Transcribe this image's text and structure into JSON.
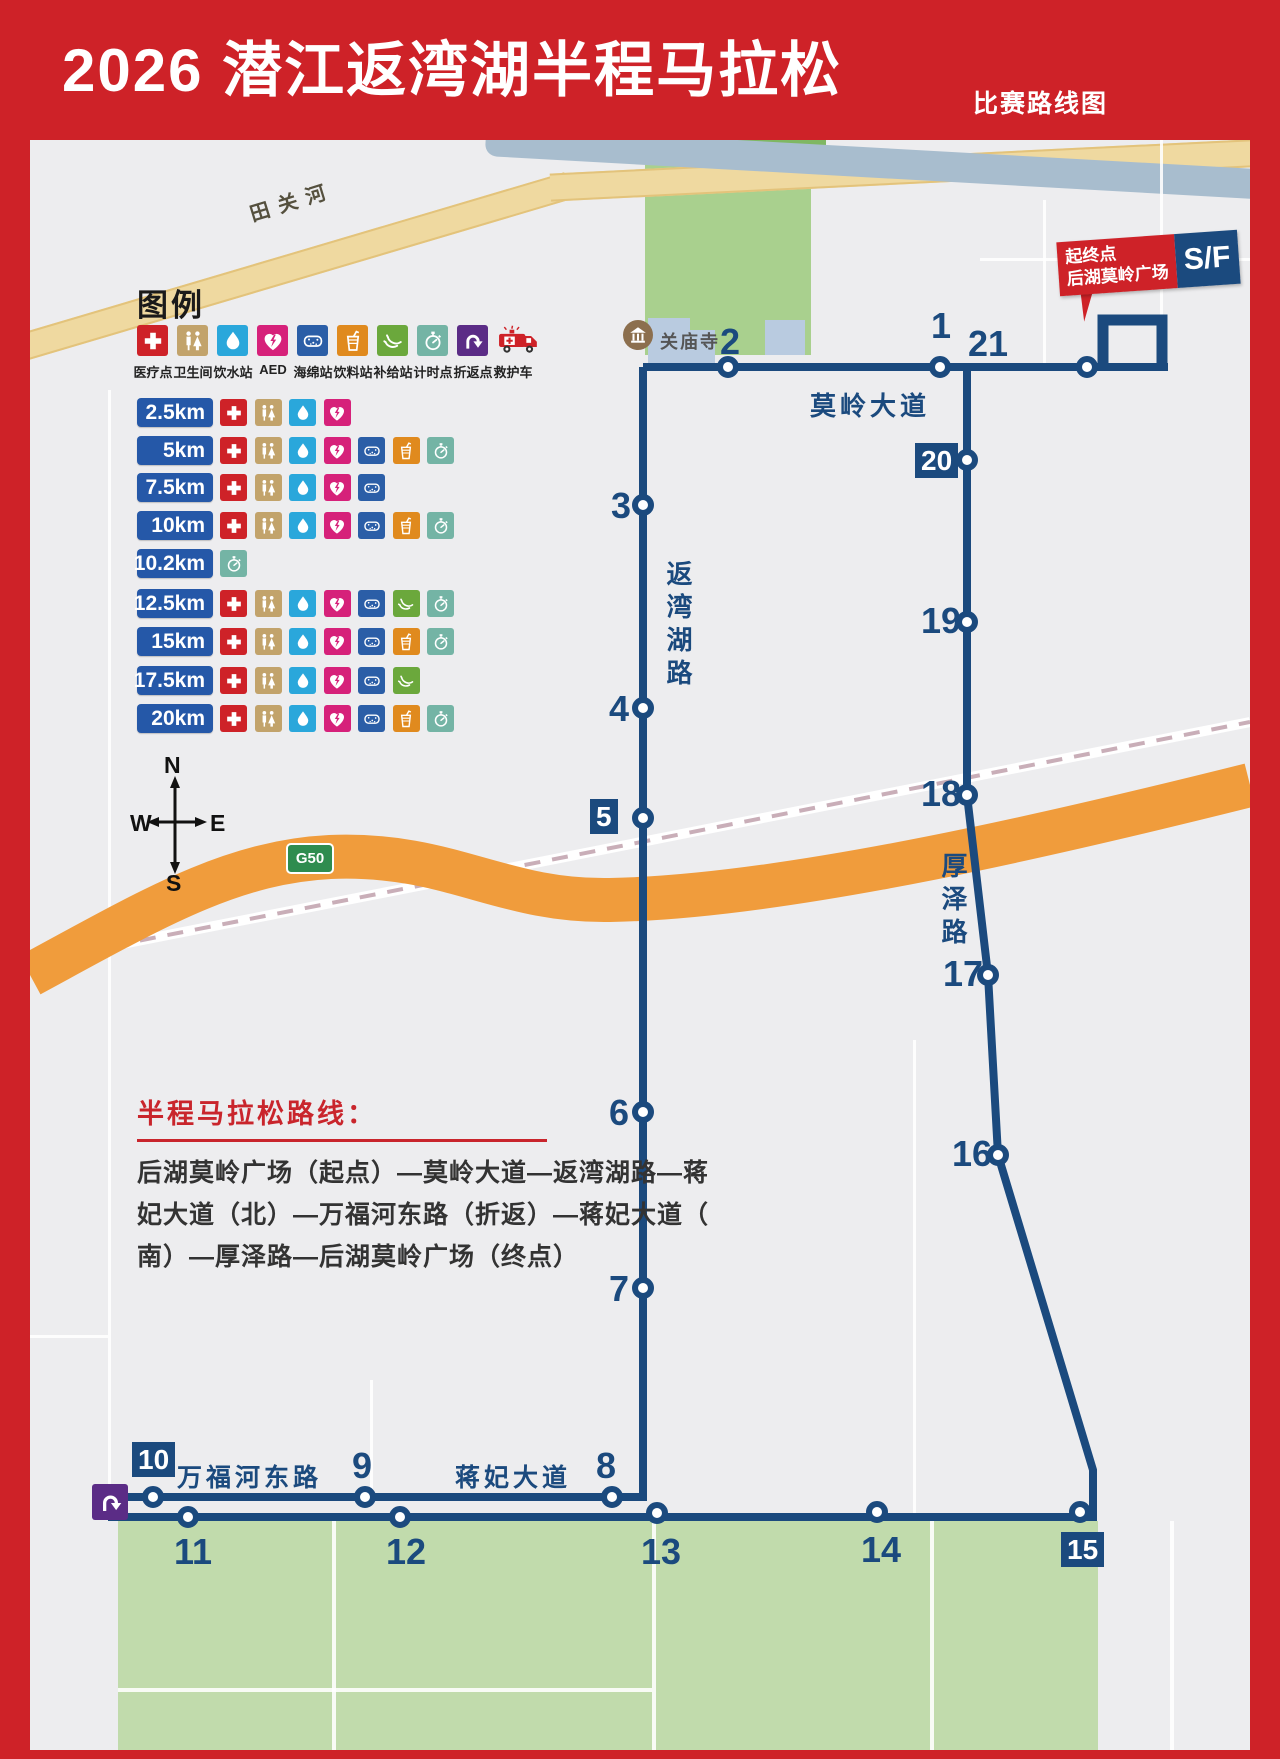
{
  "header": {
    "title": "2026 潜江返湾湖半程马拉松",
    "subtitle": "比赛路线图"
  },
  "legend": {
    "title": "图例",
    "items": [
      {
        "icon": "medical",
        "label": "医疗点"
      },
      {
        "icon": "toilet",
        "label": "卫生间"
      },
      {
        "icon": "water",
        "label": "饮水站"
      },
      {
        "icon": "aed",
        "label": "AED"
      },
      {
        "icon": "sponge",
        "label": "海绵站"
      },
      {
        "icon": "drink",
        "label": "饮料站"
      },
      {
        "icon": "banana",
        "label": "补给站"
      },
      {
        "icon": "timer",
        "label": "计时点"
      },
      {
        "icon": "uturn",
        "label": "折返点"
      },
      {
        "icon": "ambulance",
        "label": "救护车"
      }
    ],
    "rows": [
      {
        "km": "2.5km",
        "icons": [
          "medical",
          "toilet",
          "water",
          "aed"
        ]
      },
      {
        "km": "5km",
        "icons": [
          "medical",
          "toilet",
          "water",
          "aed",
          "sponge",
          "drink",
          "timer"
        ]
      },
      {
        "km": "7.5km",
        "icons": [
          "medical",
          "toilet",
          "water",
          "aed",
          "sponge"
        ]
      },
      {
        "km": "10km",
        "icons": [
          "medical",
          "toilet",
          "water",
          "aed",
          "sponge",
          "drink",
          "timer"
        ]
      },
      {
        "km": "10.2km",
        "icons": [
          "timer"
        ]
      },
      {
        "km": "12.5km",
        "icons": [
          "medical",
          "toilet",
          "water",
          "aed",
          "sponge",
          "banana",
          "timer"
        ]
      },
      {
        "km": "15km",
        "icons": [
          "medical",
          "toilet",
          "water",
          "aed",
          "sponge",
          "drink",
          "timer"
        ]
      },
      {
        "km": "17.5km",
        "icons": [
          "medical",
          "toilet",
          "water",
          "aed",
          "sponge",
          "banana"
        ]
      },
      {
        "km": "20km",
        "icons": [
          "medical",
          "toilet",
          "water",
          "aed",
          "sponge",
          "drink",
          "timer"
        ]
      }
    ]
  },
  "compass": {
    "n": "N",
    "s": "S",
    "w": "W",
    "e": "E"
  },
  "map": {
    "river_label": "田关河",
    "temple_label": "关庙寺",
    "g50": "G50",
    "sf": {
      "line1": "起终点",
      "line2": "后湖莫岭广场",
      "badge": "S/F"
    },
    "roads": {
      "moling": "莫岭大道",
      "fanwanhu": "返湾湖路",
      "houze": "厚泽路",
      "wanfuhe": "万福河东路",
      "jiangfei": "蒋妃大道"
    },
    "markers": [
      {
        "n": "1",
        "cx": 910,
        "cy": 227,
        "lx": 901,
        "ly": 168,
        "badge": false
      },
      {
        "n": "2",
        "cx": 698,
        "cy": 227,
        "lx": 690,
        "ly": 184,
        "badge": false
      },
      {
        "n": "3",
        "cx": 613,
        "cy": 365,
        "lx": 581,
        "ly": 348,
        "badge": false
      },
      {
        "n": "4",
        "cx": 613,
        "cy": 568,
        "lx": 579,
        "ly": 551,
        "badge": false
      },
      {
        "n": "5",
        "cx": 613,
        "cy": 678,
        "lx": 560,
        "ly": 659,
        "badge": true
      },
      {
        "n": "6",
        "cx": 613,
        "cy": 972,
        "lx": 579,
        "ly": 955,
        "badge": false
      },
      {
        "n": "7",
        "cx": 613,
        "cy": 1148,
        "lx": 579,
        "ly": 1131,
        "badge": false
      },
      {
        "n": "8",
        "cx": 582,
        "cy": 1357,
        "lx": 566,
        "ly": 1308,
        "badge": false
      },
      {
        "n": "9",
        "cx": 335,
        "cy": 1357,
        "lx": 322,
        "ly": 1308,
        "badge": false
      },
      {
        "n": "10",
        "cx": 123,
        "cy": 1357,
        "lx": 102,
        "ly": 1302,
        "badge": true
      },
      {
        "n": "11",
        "cx": 158,
        "cy": 1377,
        "lx": 144,
        "ly": 1394,
        "badge": false
      },
      {
        "n": "12",
        "cx": 370,
        "cy": 1377,
        "lx": 356,
        "ly": 1394,
        "badge": false
      },
      {
        "n": "13",
        "cx": 627,
        "cy": 1373,
        "lx": 611,
        "ly": 1394,
        "badge": false
      },
      {
        "n": "14",
        "cx": 847,
        "cy": 1372,
        "lx": 831,
        "ly": 1392,
        "badge": false
      },
      {
        "n": "15",
        "cx": 1050,
        "cy": 1372,
        "lx": 1031,
        "ly": 1392,
        "badge": true
      },
      {
        "n": "16",
        "cx": 968,
        "cy": 1015,
        "lx": 922,
        "ly": 996,
        "badge": false
      },
      {
        "n": "17",
        "cx": 958,
        "cy": 835,
        "lx": 913,
        "ly": 816,
        "badge": false
      },
      {
        "n": "18",
        "cx": 937,
        "cy": 655,
        "lx": 891,
        "ly": 636,
        "badge": false
      },
      {
        "n": "19",
        "cx": 937,
        "cy": 482,
        "lx": 891,
        "ly": 463,
        "badge": false
      },
      {
        "n": "20",
        "cx": 937,
        "cy": 320,
        "lx": 885,
        "ly": 303,
        "badge": true
      },
      {
        "n": "21",
        "cx": null,
        "cy": null,
        "lx": 938,
        "ly": 186,
        "badge": false
      },
      {
        "n": "",
        "cx": 1057,
        "cy": 227,
        "lx": 0,
        "ly": 0,
        "badge": false
      }
    ]
  },
  "route_info": {
    "title": "半程马拉松路线：",
    "lines": [
      "后湖莫岭广场（起点）—莫岭大道—返湾湖路—蒋",
      "妃大道（北）—万福河东路（折返）—蒋妃大道（",
      "南）—厚泽路—后湖莫岭广场（终点）"
    ]
  },
  "colors": {
    "header_red": "#CE2228",
    "route_navy": "#1B4A7E",
    "km_badge_blue": "#2558A8",
    "highway_orange": "#F09C3C",
    "park_green": "#A9D08E",
    "field_green": "#C1DBAC",
    "medical": "#CE2228",
    "toilet": "#C2A36B",
    "water": "#2AA7DB",
    "aed": "#D6217A",
    "sponge": "#2B5EA7",
    "drink": "#E08A1E",
    "banana": "#6BA83C",
    "timer": "#74B4A5",
    "uturn": "#5B2C86"
  }
}
